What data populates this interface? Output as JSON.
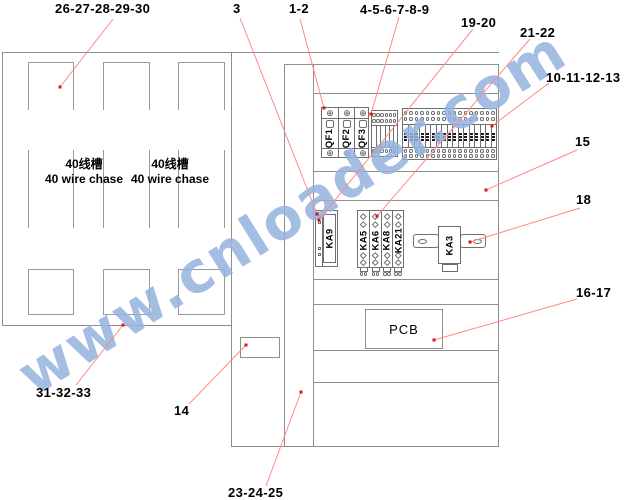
{
  "watermark": {
    "text": "www.cnloader.com",
    "color": "#94b2de"
  },
  "colors": {
    "structure_gray": "#8e8e8e",
    "component_gray": "#6f6f6f",
    "callout_line_red": "#ff8888",
    "callout_dot_red": "#e31212",
    "label_black": "#000000"
  },
  "wire_chase": {
    "cn": "40线槽",
    "en": "40 wire chase"
  },
  "callouts": [
    {
      "text": "26-27-28-29-30",
      "x": 55,
      "y": 1,
      "line": [
        113,
        19,
        60,
        87
      ]
    },
    {
      "text": "3",
      "x": 233,
      "y": 1,
      "line": [
        240,
        18,
        317,
        214
      ]
    },
    {
      "text": "1-2",
      "x": 289,
      "y": 1,
      "line": [
        300,
        19,
        324,
        108
      ]
    },
    {
      "text": "4-5-6-7-8-9",
      "x": 360,
      "y": 2,
      "line": [
        399,
        17,
        371,
        114
      ]
    },
    {
      "text": "19-20",
      "x": 461,
      "y": 15,
      "line": [
        473,
        29,
        319,
        220
      ]
    },
    {
      "text": "21-22",
      "x": 520,
      "y": 25,
      "line": [
        530,
        39,
        377,
        216
      ]
    },
    {
      "text": "10-11-12-13",
      "x": 546,
      "y": 70,
      "line": [
        549,
        83,
        492,
        126
      ]
    },
    {
      "text": "15",
      "x": 575,
      "y": 134,
      "line": [
        577,
        150,
        486,
        190
      ]
    },
    {
      "text": "18",
      "x": 576,
      "y": 192,
      "line": [
        580,
        208,
        470,
        242
      ]
    },
    {
      "text": "16-17",
      "x": 576,
      "y": 285,
      "line": [
        577,
        299,
        434,
        340
      ]
    },
    {
      "text": "31-32-33",
      "x": 36,
      "y": 385,
      "line": [
        76,
        385,
        123,
        325
      ]
    },
    {
      "text": "14",
      "x": 174,
      "y": 403,
      "line": [
        189,
        404,
        246,
        345
      ]
    },
    {
      "text": "23-24-25",
      "x": 228,
      "y": 485,
      "line": [
        266,
        486,
        301,
        392
      ]
    }
  ],
  "components": {
    "breakers": [
      "QF1",
      "QF2",
      "QF3"
    ],
    "terminal_strip_small_count": 6,
    "terminal_strip_large_count": 17,
    "relay_left": "KA9",
    "relay_bank": [
      "KA5",
      "KA6",
      "KA8",
      "KA21"
    ],
    "relay_right": "KA3",
    "pcb": "PCB"
  }
}
